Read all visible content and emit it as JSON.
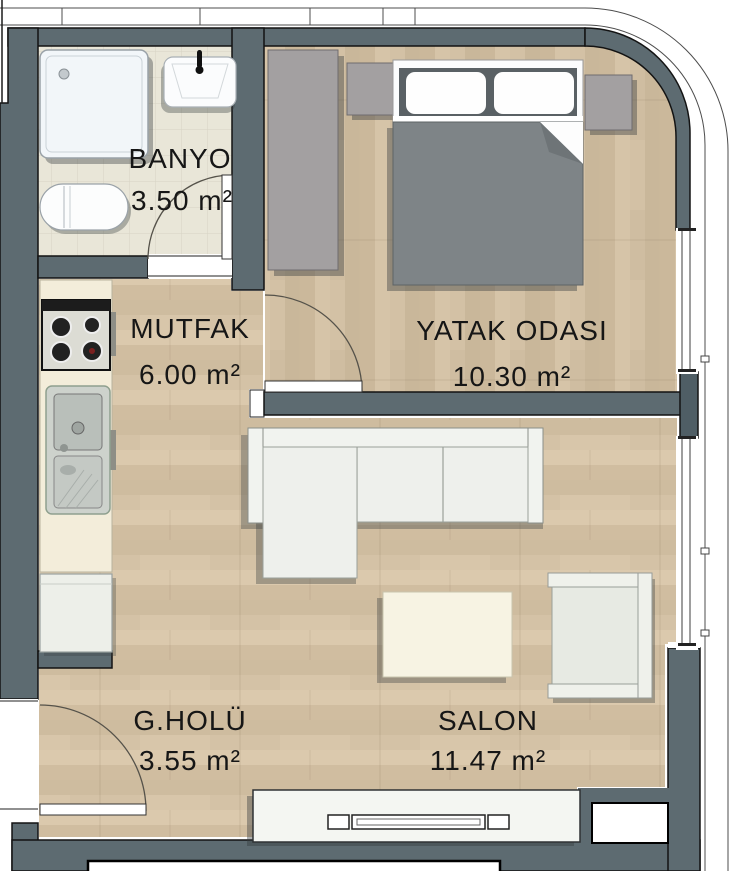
{
  "plan": {
    "title": "apartment-floor-plan",
    "rooms": [
      {
        "name": "BANYO",
        "area": "3.50 m²"
      },
      {
        "name": "MUTFAK",
        "area": "6.00 m²"
      },
      {
        "name": "YATAK ODASI",
        "area": "10.30 m²"
      },
      {
        "name": "G.HOLÜ",
        "area": "3.55 m²"
      },
      {
        "name": "SALON",
        "area": "11.47 m²"
      }
    ],
    "colors": {
      "wall": "#5d6b71",
      "wall_pier": "#4f5e65",
      "floor_wood": "#d4c2a6",
      "floor_bath": "#e9e6d8",
      "counter_cream": "#f3edda",
      "furniture_gray": "#a3a0a1",
      "bed_gray": "#7e8487",
      "sofa_white": "#eef0ec",
      "outline_black": "#131313"
    }
  }
}
